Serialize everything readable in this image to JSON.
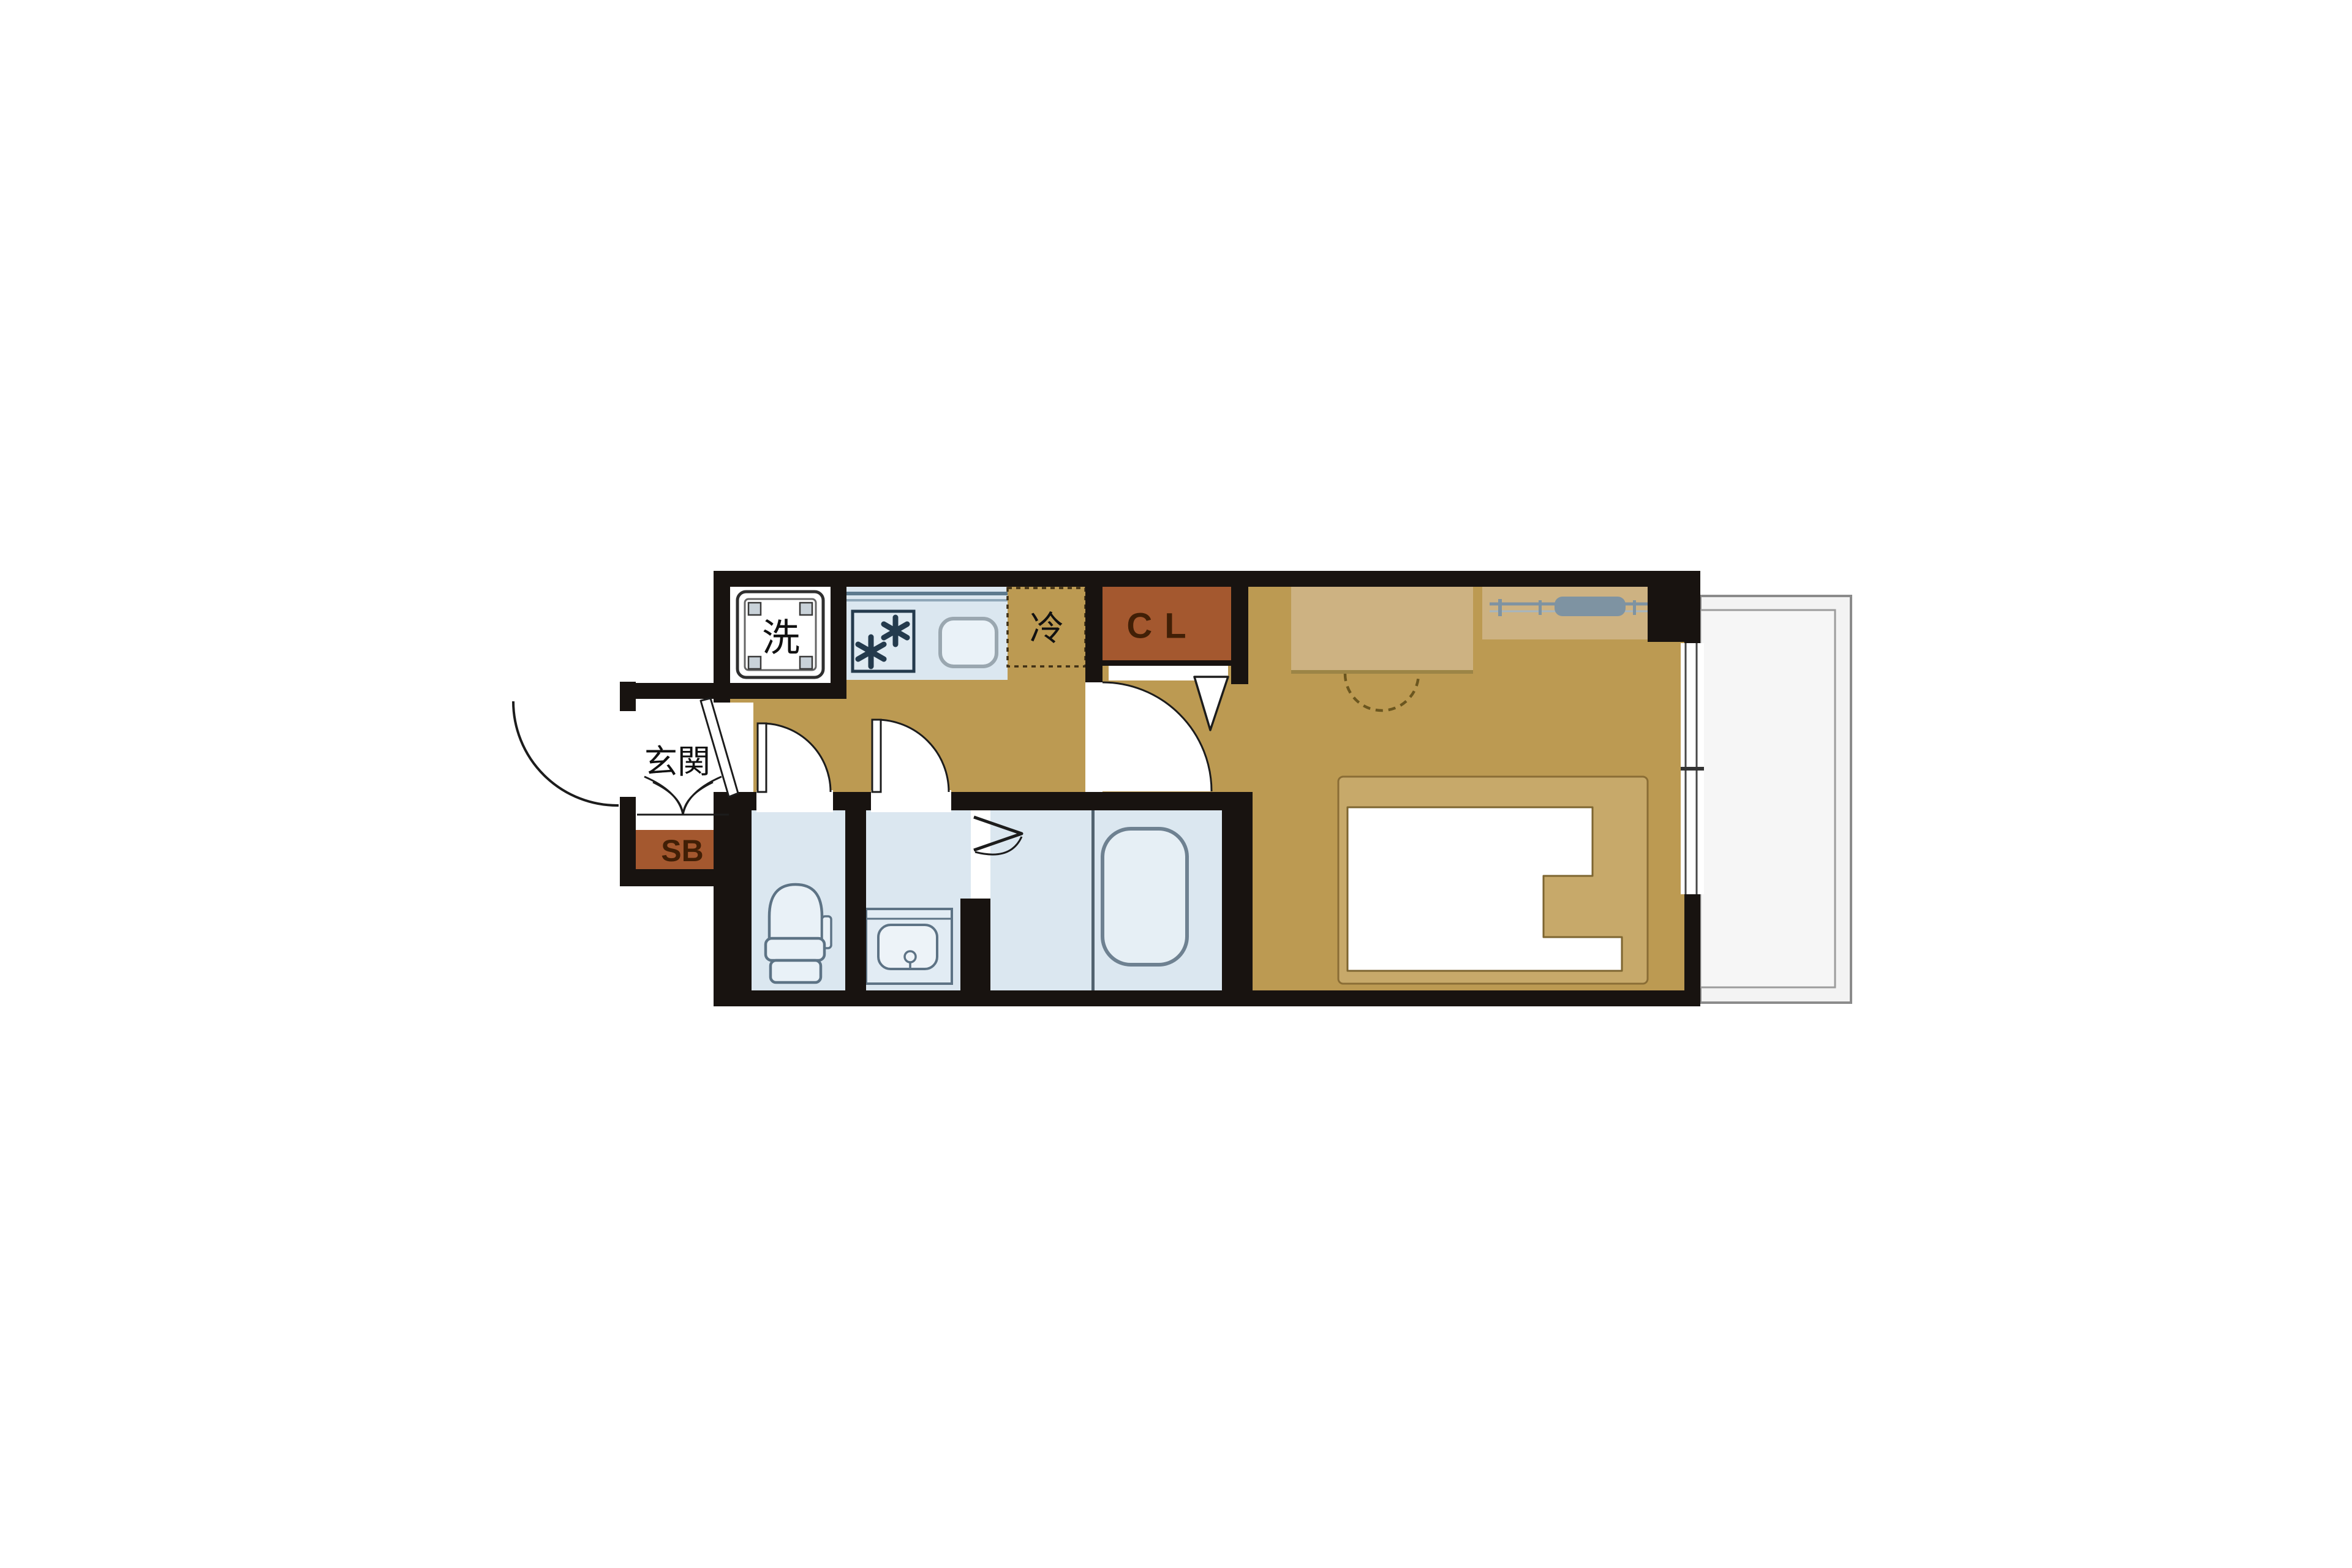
{
  "page": {
    "kind": "apartment-floor-plan",
    "background": "#ffffff"
  },
  "palette": {
    "wall": "#181310",
    "floor": "#bc9a52",
    "floor_light": "#cdb282",
    "bed_frame": "#c7a96a",
    "closet": "#a4582f",
    "closet_text": "#411f06",
    "wet_floor": "#dbe7f0",
    "fixture_fill": "#e9f1f7",
    "fixture_stroke": "#5d7385",
    "balcony_fill": "#f3f3f3",
    "balcony_stroke": "#8b8b8b",
    "rail": "#7e93a2",
    "line": "#1c1c1c"
  },
  "labels": {
    "washing_machine": "洗",
    "refrigerator": "冷",
    "closet": "CL",
    "entrance": "玄関",
    "shoe_box": "SB"
  }
}
